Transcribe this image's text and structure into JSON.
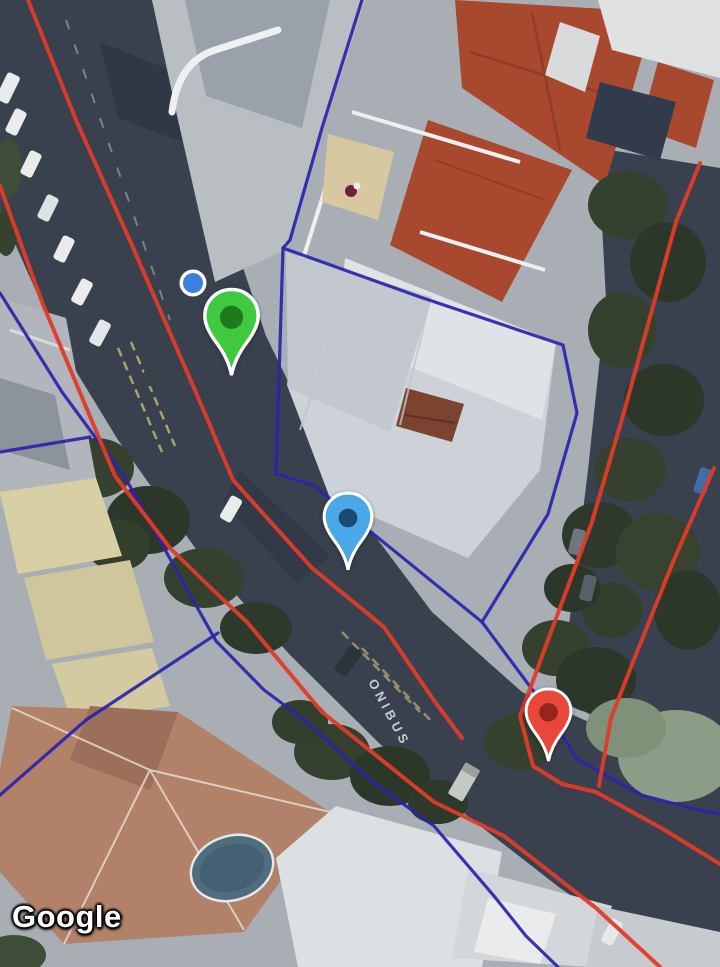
{
  "map": {
    "view": "satellite",
    "attribution": "Google",
    "road_marking": "ONIBUS",
    "markers": [
      {
        "id": "marker-green",
        "kind": "pin",
        "color": "#3fc93f",
        "inner_color": "#1d7a1d",
        "x": 200,
        "y": 286
      },
      {
        "id": "marker-blue",
        "kind": "pin",
        "color": "#4aa7e8",
        "inner_color": "#1c4a6e",
        "x": 320,
        "y": 490
      },
      {
        "id": "marker-red",
        "kind": "pin",
        "color": "#e8483a",
        "inner_color": "#96261c",
        "x": 522,
        "y": 686
      },
      {
        "id": "location-dot",
        "kind": "dot",
        "color": "#3b7fe0",
        "inner_color": "#3b7fe0",
        "x": 178,
        "y": 268
      }
    ],
    "overlays": {
      "red_color": "#e23b28",
      "navy_color": "#2c22ae",
      "red_paths": {
        "west": "M 0,186 L 42,302 L 115,476 L 170,548 L 213,590 L 247,622 L 322,712 L 434,802 L 504,836 L 596,908 L 660,967",
        "center": "M 28,0 L 76,120 L 131,243 L 200,402 L 233,480 L 312,568 L 384,627 L 435,702 L 462,738",
        "east": "M 700,163 L 676,222 L 646,332 L 624,412 L 592,522 L 548,640 L 520,716 L 533,766 L 562,784 L 596,792 L 663,829 L 720,864",
        "east_inner": "M 714,468 L 673,562 L 633,662 L 611,718 L 599,786"
      },
      "navy_paths": {
        "west": "M 0,293 L 62,392 L 126,479 L 174,566 L 216,641 L 264,690 L 303,719 L 374,783 L 434,826 L 494,896 L 526,936 L 558,967",
        "west_spur": "M 0,452 L 90,437",
        "north": "M 362,0 L 322,128 L 290,240 L 283,248",
        "parcel": "M 283,248 L 420,297 L 563,345 L 577,413 L 548,514 L 482,622 L 313,485 L 276,474 Z",
        "southeast": "M 482,622 L 540,700 L 577,759 L 641,795 L 695,809 L 720,814",
        "corner_bl": "M 0,795 L 86,720 L 218,633"
      }
    }
  }
}
